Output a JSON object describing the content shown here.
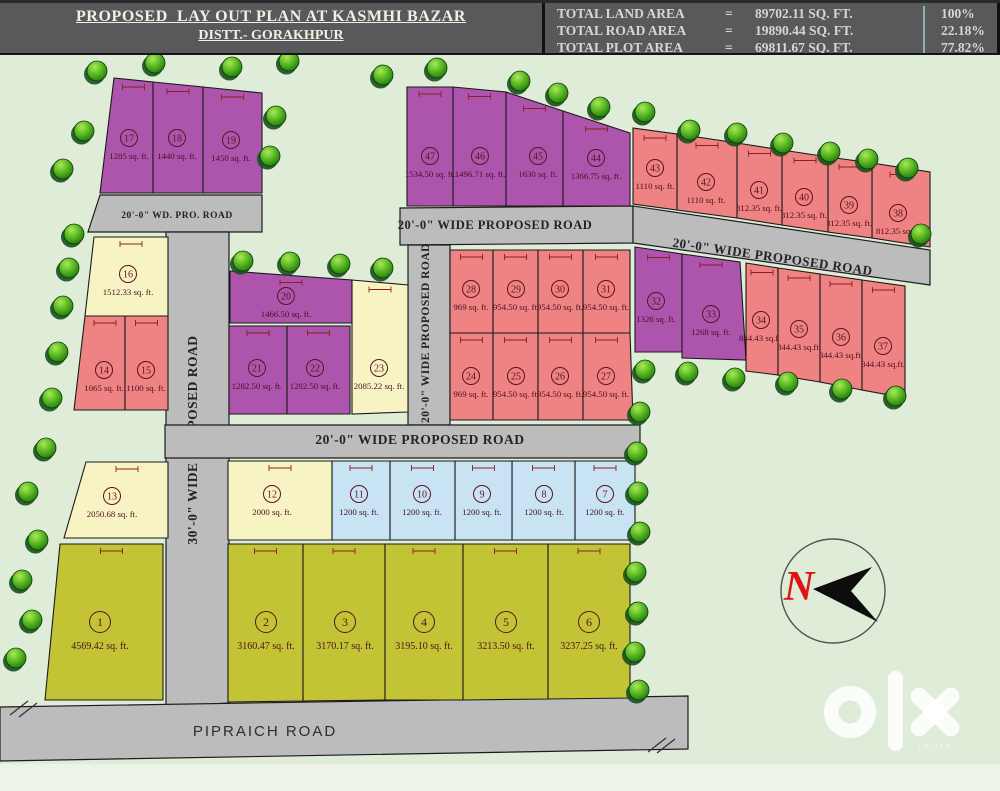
{
  "header": {
    "title_line1": "PROPOSED  LAY OUT PLAN AT KASMHI BAZAR",
    "title_line2": "DISTT.- GORAKHPUR",
    "stats": [
      {
        "label": "TOTAL LAND AREA",
        "eq": "=",
        "value": "89702.11 SQ. FT.",
        "pct": "100%"
      },
      {
        "label": "TOTAL ROAD AREA",
        "eq": "=",
        "value": "19890.44 SQ. FT.",
        "pct": "22.18%"
      },
      {
        "label": "TOTAL PLOT AREA",
        "eq": "=",
        "value": "69811.67 SQ. FT.",
        "pct": "77.82%"
      }
    ]
  },
  "colors": {
    "background": "#dfecd8",
    "background_light": "#ecf4e8",
    "road": "#bcbcbc",
    "purple": "#ad54ad",
    "red": "#ef8282",
    "paleyellow": "#f7f3c3",
    "blue": "#c8e3f3",
    "olive": "#c3c336",
    "plot_text": "#5c1220",
    "dimension": "#8b2020",
    "north_red": "#dd1414"
  },
  "map": {
    "roads": [
      {
        "text": "20'-0\" WD. PRO. ROAD",
        "pts": "100,195 262,195 262,232 88,232",
        "lx": 177,
        "ly": 218,
        "rot": 0,
        "fs": 9.5
      },
      {
        "text": "30'-0\" WIDE PROPOSED ROAD",
        "pts": "166,232 229,232 229,703 166,707",
        "lx": 197,
        "ly": 440,
        "rot": -90,
        "fs": 13.5
      },
      {
        "text": "20'-0\" WIDE PROPOSED ROAD",
        "pts": "400,208 633,206 633,243 400,245",
        "lx": 495,
        "ly": 229,
        "rot": 0,
        "fs": 12.5
      },
      {
        "text": "20'-0\" WIDE PROPOSED ROAD",
        "pts": "408,245 450,245 450,425 408,425",
        "lx": 429,
        "ly": 333,
        "rot": -90,
        "fs": 11.5
      },
      {
        "text": "20'-0\" WIDE PROPOSED ROAD",
        "pts": "633,206 930,250 930,285 633,243",
        "lx": 772,
        "ly": 261,
        "rot": 8.2,
        "fs": 13
      },
      {
        "text": "20'-0\" WIDE PROPOSED ROAD",
        "pts": "165,425 640,425 640,458 165,458",
        "lx": 420,
        "ly": 444,
        "rot": 0,
        "fs": 13.5
      },
      {
        "text": "PIPRAICH ROAD",
        "pts": "0,707 688,696 688,749 0,761",
        "lx": 265,
        "ly": 736,
        "rot": 0,
        "fs": 15,
        "sans": true
      }
    ],
    "plots": [
      {
        "n": "1",
        "area": "4569.42 sq. ft.",
        "c": "olive",
        "pts": "60,544 163,544 163,700 45,700",
        "lx": 100,
        "ly": 622
      },
      {
        "n": "2",
        "area": "3160.47 sq. ft.",
        "c": "olive",
        "pts": "228,544 303,544 303,701 228,702",
        "lx": 266,
        "ly": 622
      },
      {
        "n": "3",
        "area": "3170.17 sq. ft.",
        "c": "olive",
        "pts": "303,544 385,544 385,700 303,701",
        "lx": 345,
        "ly": 622
      },
      {
        "n": "4",
        "area": "3195.10 sq. ft.",
        "c": "olive",
        "pts": "385,544 463,544 463,700 385,700",
        "lx": 424,
        "ly": 622
      },
      {
        "n": "5",
        "area": "3213.50 sq. ft.",
        "c": "olive",
        "pts": "463,544 548,544 548,699 463,700",
        "lx": 506,
        "ly": 622
      },
      {
        "n": "6",
        "area": "3237.25 sq. ft.",
        "c": "olive",
        "pts": "548,544 630,544 630,698 548,699",
        "lx": 589,
        "ly": 622
      },
      {
        "n": "7",
        "area": "1200 sq. ft.",
        "c": "blue",
        "pts": "575,461 635,461 635,540 575,540",
        "lx": 605,
        "ly": 494
      },
      {
        "n": "8",
        "area": "1200 sq. ft.",
        "c": "blue",
        "pts": "512,461 575,461 575,540 512,540",
        "lx": 544,
        "ly": 494
      },
      {
        "n": "9",
        "area": "1200 sq. ft.",
        "c": "blue",
        "pts": "455,461 512,461 512,540 455,540",
        "lx": 482,
        "ly": 494
      },
      {
        "n": "10",
        "area": "1200 sq. ft.",
        "c": "blue",
        "pts": "390,461 455,461 455,540 390,540",
        "lx": 422,
        "ly": 494
      },
      {
        "n": "11",
        "area": "1200 sq. ft.",
        "c": "blue",
        "pts": "332,461 390,461 390,540 332,540",
        "lx": 359,
        "ly": 494
      },
      {
        "n": "12",
        "area": "2000 sq. ft.",
        "c": "paleyellow",
        "pts": "228,461 332,461 332,540 228,540",
        "lx": 272,
        "ly": 494
      },
      {
        "n": "13",
        "area": "2050.68 sq. ft.",
        "c": "paleyellow",
        "pts": "86,462 168,462 168,538 64,538",
        "lx": 112,
        "ly": 496
      },
      {
        "n": "14",
        "area": "1065 sq. ft.",
        "c": "red",
        "pts": "85,316 125,316 125,410 74,410",
        "lx": 104,
        "ly": 370
      },
      {
        "n": "15",
        "area": "1100 sq. ft.",
        "c": "red",
        "pts": "125,316 168,316 168,410 125,410",
        "lx": 146,
        "ly": 370
      },
      {
        "n": "16",
        "area": "1512.33 sq. ft.",
        "c": "paleyellow",
        "pts": "94,237 168,237 168,316 85,316",
        "lx": 128,
        "ly": 274
      },
      {
        "n": "17",
        "area": "1285 sq. ft.",
        "c": "purple",
        "pts": "114,78 153,82 153,193 100,193",
        "lx": 129,
        "ly": 138
      },
      {
        "n": "18",
        "area": "1440 sq. ft.",
        "c": "purple",
        "pts": "153,82 203,87 203,193 153,193",
        "lx": 177,
        "ly": 138
      },
      {
        "n": "19",
        "area": "1450 sq. ft.",
        "c": "purple",
        "pts": "203,87 262,93 262,193 203,193",
        "lx": 231,
        "ly": 140
      },
      {
        "n": "20",
        "area": "1466.50 sq. ft.",
        "c": "purple",
        "pts": "230,271 352,280 352,323 230,323",
        "lx": 286,
        "ly": 296
      },
      {
        "n": "21",
        "area": "1282.50 sq. ft.",
        "c": "purple",
        "pts": "229,326 287,326 287,414 229,414",
        "lx": 257,
        "ly": 368
      },
      {
        "n": "22",
        "area": "1282.50 sq. ft.",
        "c": "purple",
        "pts": "287,326 350,326 350,414 287,414",
        "lx": 315,
        "ly": 368
      },
      {
        "n": "23",
        "area": "2085.22 sq. ft.",
        "c": "paleyellow",
        "pts": "352,280 408,285 408,412 352,414",
        "lx": 379,
        "ly": 368
      },
      {
        "n": "24",
        "area": "969 sq. ft.",
        "c": "red",
        "pts": "450,333 493,333 493,420 450,420",
        "lx": 471,
        "ly": 376
      },
      {
        "n": "25",
        "area": "954.50 sq. ft.",
        "c": "red",
        "pts": "493,333 538,333 538,420 493,420",
        "lx": 516,
        "ly": 376
      },
      {
        "n": "26",
        "area": "954.50 sq. ft.",
        "c": "red",
        "pts": "538,333 583,333 583,420 538,420",
        "lx": 560,
        "ly": 376
      },
      {
        "n": "27",
        "area": "954.50 sq. ft.",
        "c": "red",
        "pts": "583,333 630,333 633,420 583,420",
        "lx": 606,
        "ly": 376
      },
      {
        "n": "28",
        "area": "969 sq. ft.",
        "c": "red",
        "pts": "450,250 493,250 493,333 450,333",
        "lx": 471,
        "ly": 289
      },
      {
        "n": "29",
        "area": "954.50 sq. ft.",
        "c": "red",
        "pts": "493,250 538,250 538,333 493,333",
        "lx": 516,
        "ly": 289
      },
      {
        "n": "30",
        "area": "954.50 sq. ft.",
        "c": "red",
        "pts": "538,250 583,250 583,333 538,333",
        "lx": 560,
        "ly": 289
      },
      {
        "n": "31",
        "area": "954.50 sq. ft.",
        "c": "red",
        "pts": "583,250 630,250 630,333 583,333",
        "lx": 606,
        "ly": 289
      },
      {
        "n": "32",
        "area": "1326 sq. ft.",
        "c": "purple",
        "pts": "635,247 682,254 682,352 635,352",
        "lx": 656,
        "ly": 301
      },
      {
        "n": "33",
        "area": "1268 sq. ft.",
        "c": "purple",
        "pts": "682,254 740,262 746,360 682,358",
        "lx": 711,
        "ly": 314
      },
      {
        "n": "34",
        "area": "844.43 sq.ft.",
        "c": "red",
        "pts": "746,263 778,268 778,375 746,371",
        "lx": 761,
        "ly": 320
      },
      {
        "n": "35",
        "area": "844.43 sq.ft.",
        "c": "red",
        "pts": "778,268 820,274 820,382 778,375",
        "lx": 799,
        "ly": 329
      },
      {
        "n": "36",
        "area": "844.43 sq.ft.",
        "c": "red",
        "pts": "820,274 862,280 862,390 820,382",
        "lx": 841,
        "ly": 337
      },
      {
        "n": "37",
        "area": "844.43 sq.ft.",
        "c": "red",
        "pts": "862,280 905,286 905,398 862,390",
        "lx": 883,
        "ly": 346
      },
      {
        "n": "38",
        "area": "812.35 sq.ft.",
        "c": "red",
        "pts": "872,163 930,172 930,247 872,238",
        "lx": 898,
        "ly": 213
      },
      {
        "n": "39",
        "area": "812.35 sq. ft.",
        "c": "red",
        "pts": "828,157 872,163 872,238 828,232",
        "lx": 849,
        "ly": 205
      },
      {
        "n": "40",
        "area": "812.35 sq. ft.",
        "c": "red",
        "pts": "782,150 828,157 828,232 782,225",
        "lx": 804,
        "ly": 197
      },
      {
        "n": "41",
        "area": "812.35 sq. ft.",
        "c": "red",
        "pts": "737,143 782,150 782,225 737,218",
        "lx": 759,
        "ly": 190
      },
      {
        "n": "42",
        "area": "1110 sq. ft.",
        "c": "red",
        "pts": "677,134 737,143 737,218 677,210",
        "lx": 706,
        "ly": 182
      },
      {
        "n": "43",
        "area": "1110 sq. ft.",
        "c": "red",
        "pts": "633,128 677,134 677,210 633,204",
        "lx": 655,
        "ly": 168
      },
      {
        "n": "44",
        "area": "1366.75 sq. ft.",
        "c": "purple",
        "pts": "563,111 630,133 630,206 563,206",
        "lx": 596,
        "ly": 158
      },
      {
        "n": "45",
        "area": "1630 sq. ft.",
        "c": "purple",
        "pts": "506,92 563,111 563,206 506,206",
        "lx": 538,
        "ly": 156
      },
      {
        "n": "46",
        "area": "1496.71 sq. ft.",
        "c": "purple",
        "pts": "453,87 506,92 506,206 453,206",
        "lx": 480,
        "ly": 156
      },
      {
        "n": "47",
        "area": "1534.50 sq. ft.",
        "c": "purple",
        "pts": "407,87 453,87 453,206 407,206",
        "lx": 430,
        "ly": 156
      }
    ],
    "trees": [
      [
        97,
        71
      ],
      [
        155,
        63
      ],
      [
        232,
        67
      ],
      [
        289,
        61
      ],
      [
        383,
        75
      ],
      [
        437,
        68
      ],
      [
        520,
        81
      ],
      [
        558,
        93
      ],
      [
        600,
        107
      ],
      [
        645,
        112
      ],
      [
        690,
        130
      ],
      [
        737,
        133
      ],
      [
        783,
        143
      ],
      [
        830,
        152
      ],
      [
        868,
        159
      ],
      [
        908,
        168
      ],
      [
        921,
        234
      ],
      [
        84,
        131
      ],
      [
        63,
        169
      ],
      [
        276,
        116
      ],
      [
        270,
        156
      ],
      [
        74,
        234
      ],
      [
        69,
        268
      ],
      [
        63,
        306
      ],
      [
        58,
        352
      ],
      [
        52,
        398
      ],
      [
        243,
        261
      ],
      [
        290,
        262
      ],
      [
        340,
        264
      ],
      [
        383,
        268
      ],
      [
        645,
        370
      ],
      [
        688,
        372
      ],
      [
        735,
        378
      ],
      [
        788,
        382
      ],
      [
        842,
        389
      ],
      [
        896,
        396
      ],
      [
        640,
        412
      ],
      [
        637,
        452
      ],
      [
        638,
        492
      ],
      [
        640,
        532
      ],
      [
        636,
        572
      ],
      [
        638,
        612
      ],
      [
        635,
        652
      ],
      [
        639,
        690
      ],
      [
        46,
        448
      ],
      [
        28,
        492
      ],
      [
        38,
        540
      ],
      [
        22,
        580
      ],
      [
        32,
        620
      ],
      [
        16,
        658
      ]
    ],
    "break_marks": [
      [
        10,
        715,
        28,
        701
      ],
      [
        19,
        717,
        37,
        703
      ],
      [
        648,
        752,
        666,
        738
      ],
      [
        657,
        753,
        675,
        739
      ]
    ],
    "north": {
      "letter": "N",
      "cx": 833,
      "cy": 591,
      "r": 52,
      "arrow": "813,589 872,567 851,591 878,622"
    },
    "watermark": {
      "sub": "INDIA"
    }
  }
}
